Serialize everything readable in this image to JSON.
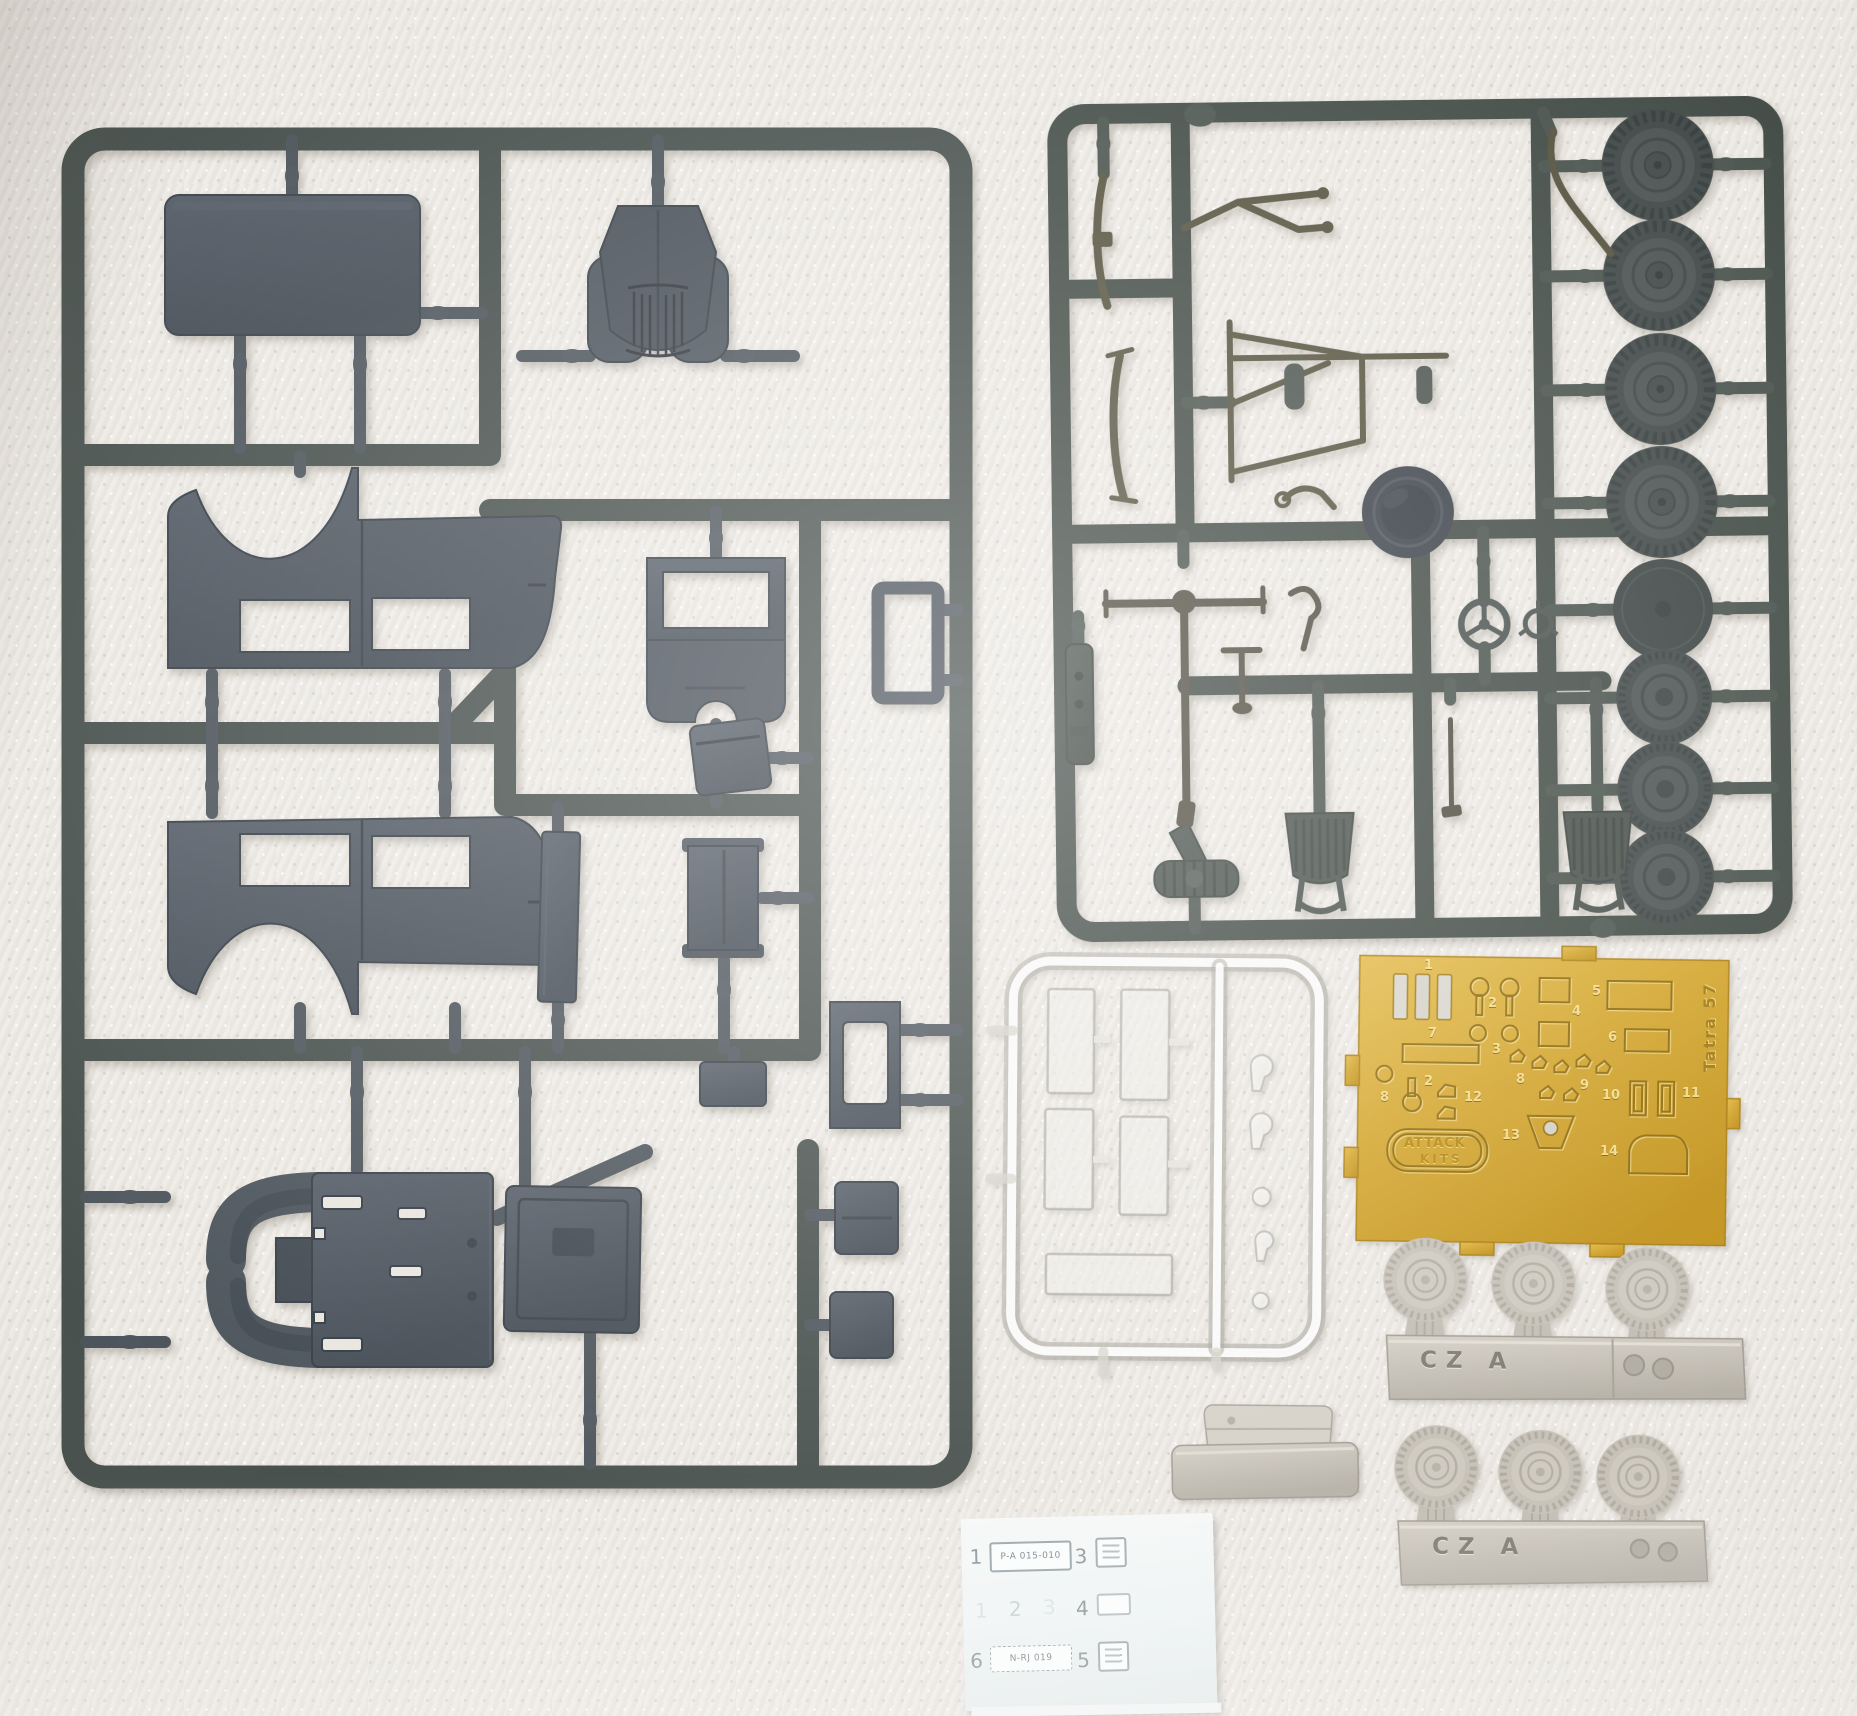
{
  "scene": {
    "subject": "Tatra 57 scale model kit contents photographed on textured paper towel",
    "items": [
      "grey styrene sprue with body panels",
      "grey styrene sprue with wheels and chassis parts",
      "clear window sprue",
      "photo-etched brass fret",
      "two resin wheel strips",
      "resin dashboard part",
      "license plate decal sheet"
    ]
  },
  "pe_fret": {
    "model_label": "Tatra 57",
    "brand_top": "ATTACK",
    "brand_bottom": "KITS",
    "numbers": [
      "1",
      "2",
      "3",
      "4",
      "5",
      "6",
      "7",
      "8",
      "9",
      "10",
      "11",
      "12",
      "13",
      "14"
    ]
  },
  "resin": {
    "strip_marking": "CZ A"
  },
  "decal_sheet": {
    "row1_num": "1",
    "row1_plate": "P-A 015-010",
    "row1b_num": "3",
    "row2_ghost1": "1",
    "row2_ghost2": "2",
    "row2_ghost3": "3",
    "row2_num": "4",
    "row3_num": "6",
    "row3_plate": "N-RJ 019",
    "row3b_num": "5"
  },
  "colors": {
    "sprue_plastic_left": "#4a525a",
    "sprue_plastic_right": "#454e49",
    "pe_gold": "#d2a42c",
    "resin": "#c8c3ba",
    "clear_part": "#f4f3f0",
    "background": "#eae7e1"
  }
}
